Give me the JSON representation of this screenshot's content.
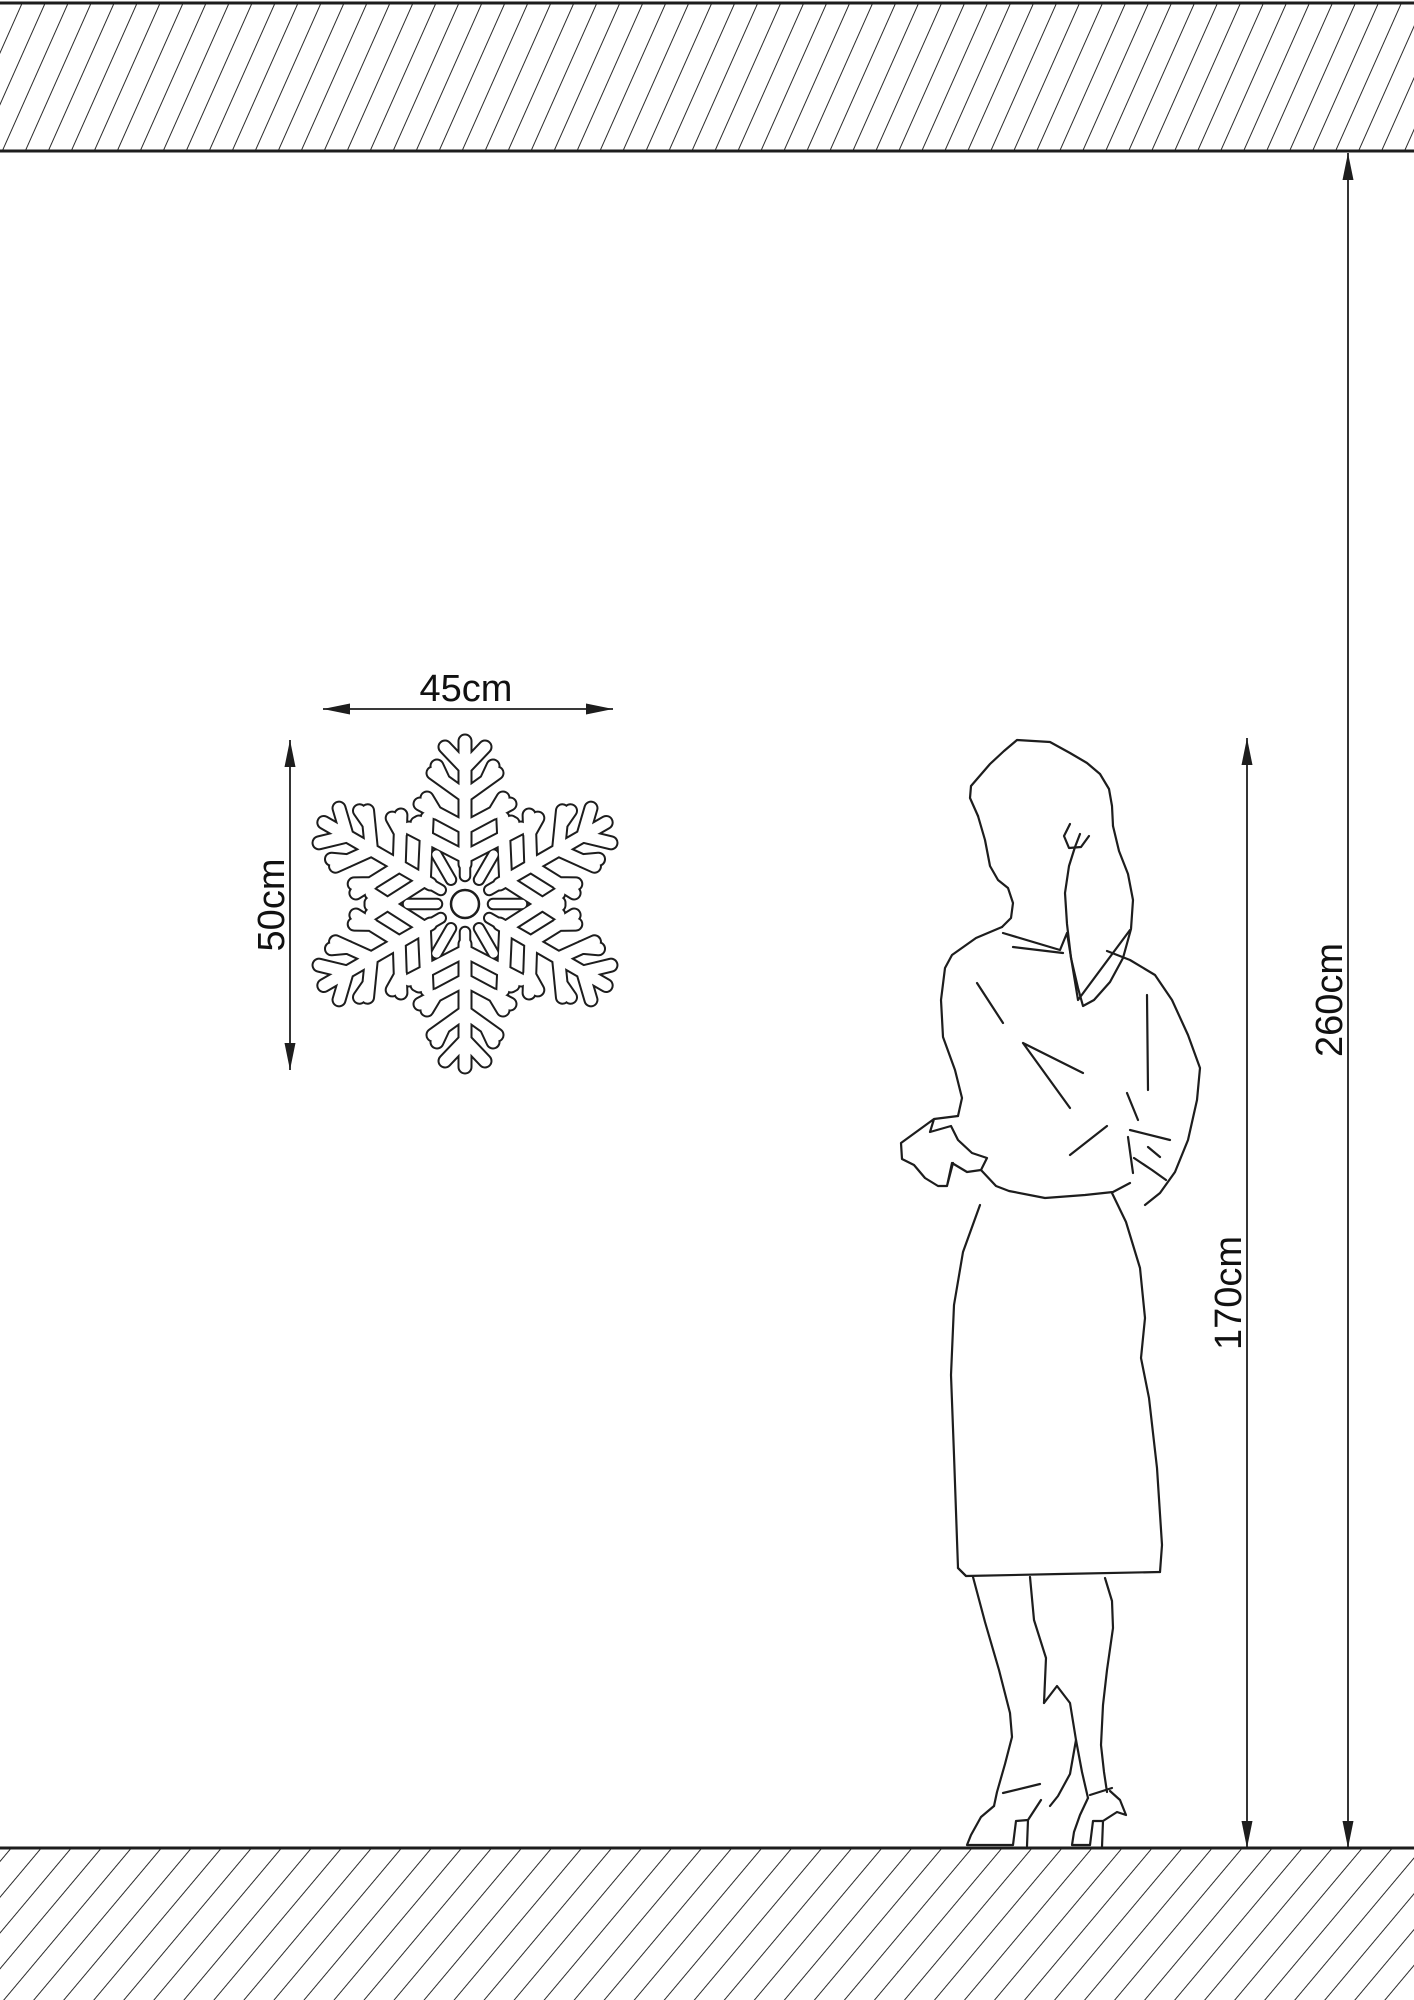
{
  "diagram": {
    "description": "Size diagram of a snowflake decoration with a standing woman shown for scale",
    "background_color": "#ffffff",
    "line_color": "#1d1d1d",
    "labels": {
      "product_width": "45cm",
      "product_height": "50cm",
      "person_height": "170cm",
      "ceiling_height": "260cm"
    },
    "icons": {
      "product": "snowflake-outline-icon",
      "person": "woman-standing-figure",
      "ceiling": "hatched-ceiling-band",
      "floor": "hatched-floor-band"
    }
  }
}
